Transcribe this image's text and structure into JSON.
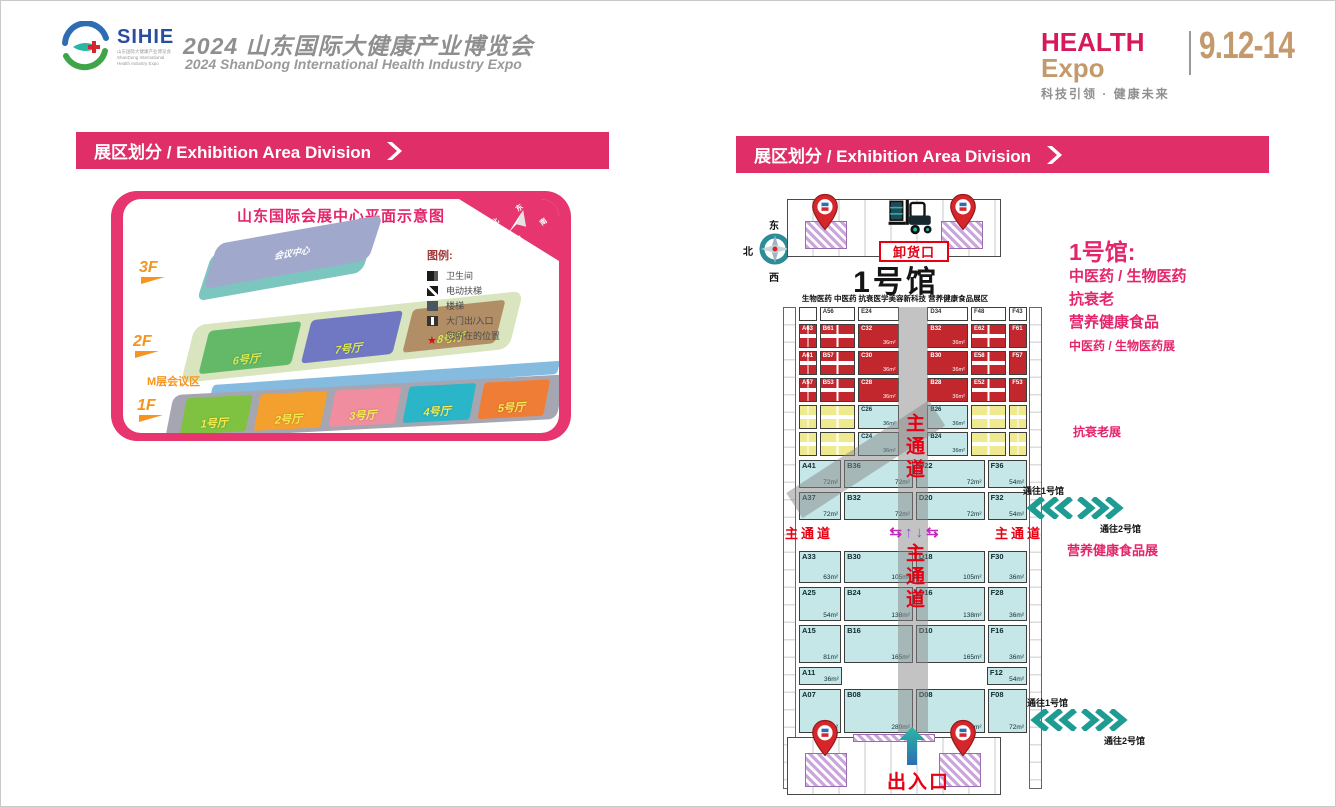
{
  "header": {
    "logo": {
      "name": "SIHIE",
      "sub": [
        {
          "t": "山东国际大健康产业博览会"
        },
        {
          "t": "ShanDong International"
        },
        {
          "t": "Health Industry Expo"
        }
      ]
    },
    "title_cn": "2024 山东国际大健康产业博览会",
    "title_en": "2024 ShanDong International Health Industry Expo",
    "brand": {
      "health": "HEALTH",
      "expo": "Expo",
      "slogan": "科技引领 · 健康未来",
      "dates": "9.12-14"
    }
  },
  "banners": {
    "left": "展区划分 / Exhibition Area Division",
    "right": "展区划分 / Exhibition Area Division"
  },
  "venue_map": {
    "title": "山东国际会展中心平面示意图",
    "compass": {
      "n": "北",
      "e": "东",
      "s": "南",
      "w": "西"
    },
    "floor_3f": "3F",
    "floor_2f": "2F",
    "floor_1f": "1F",
    "building_3f": "会议中心",
    "m_label": "M层会议区",
    "halls_2f": [
      {
        "name": "6号厅",
        "bg": "#63B968"
      },
      {
        "name": "7号厅",
        "bg": "#7078C4"
      },
      {
        "name": "8号厅",
        "bg": "#B28E67"
      }
    ],
    "halls_1f": [
      {
        "name": "1号厅",
        "bg": "#7FC242"
      },
      {
        "name": "2号厅",
        "bg": "#F4A02F"
      },
      {
        "name": "3号厅",
        "bg": "#F08EA0"
      },
      {
        "name": "4号厅",
        "bg": "#2BB5C8"
      },
      {
        "name": "5号厅",
        "bg": "#F07D35"
      }
    ],
    "legend_title": "图例:",
    "legend": [
      {
        "icon": "restroom-icon",
        "label": "卫生间"
      },
      {
        "icon": "escalator-icon",
        "label": "电动扶梯"
      },
      {
        "icon": "stairs-icon",
        "label": "楼梯"
      },
      {
        "icon": "gate-icon",
        "label": "大门出/入口"
      },
      {
        "icon": "location-star-icon",
        "label": "您所在的位置"
      }
    ]
  },
  "hall_map": {
    "compass": {
      "n": "北",
      "e": "东",
      "s": "南",
      "w": "西"
    },
    "unloading_label": "卸货口",
    "title": "1号馆",
    "subtitle": "生物医药 中医药 抗衰医学美容新科技 营养健康食品展区",
    "aisle_h": "主通道",
    "aisle_v": "主通道",
    "entrance_label": "出入口",
    "arrows": {
      "left": "⇆",
      "up": "↑",
      "down": "↓",
      "right": "⇆"
    },
    "upper_rows": [
      {
        "h": "14px",
        "cells": [
          {
            "cls": "booth",
            "l": "",
            "bg": "#FFFFFF",
            "fg": "#333333",
            "fl": "0.9"
          },
          {
            "cls": "booth",
            "l": "A56",
            "bg": "#FFFFFF",
            "fg": "#333333",
            "fl": "1.9"
          },
          {
            "cls": "booth",
            "l": "E24",
            "bg": "#FFFFFF",
            "fg": "#333333",
            "fl": "2.2"
          },
          {
            "cls": "booth empty",
            "l": "",
            "fl": "1.3"
          },
          {
            "cls": "booth",
            "l": "D34",
            "bg": "#FFFFFF",
            "fg": "#333333",
            "fl": "2.2"
          },
          {
            "cls": "booth",
            "l": "F48",
            "bg": "#FFFFFF",
            "fg": "#333333",
            "fl": "1.9"
          },
          {
            "cls": "booth",
            "l": "F43",
            "bg": "#FFFFFF",
            "fg": "#333333",
            "fl": "0.9"
          }
        ]
      },
      {
        "h": "24px",
        "cells": [
          {
            "cls": "booth quad",
            "l": "A63",
            "bg": "#C1272D",
            "fg": "#FFFFFF",
            "fl": "0.9"
          },
          {
            "cls": "booth quad",
            "l": "B61",
            "bg": "#C1272D",
            "fg": "#FFFFFF",
            "fl": "1.9"
          },
          {
            "cls": "booth",
            "l": "C32",
            "a": "36m²",
            "bg": "#C1272D",
            "fg": "#FFFFFF",
            "fl": "2.2"
          },
          {
            "cls": "booth empty",
            "l": "",
            "fl": "1.3"
          },
          {
            "cls": "booth",
            "l": "B32",
            "a": "36m²",
            "bg": "#C1272D",
            "fg": "#FFFFFF",
            "fl": "2.2"
          },
          {
            "cls": "booth quad",
            "l": "E62",
            "bg": "#C1272D",
            "fg": "#FFFFFF",
            "fl": "1.9"
          },
          {
            "cls": "booth",
            "l": "F61",
            "bg": "#C1272D",
            "fg": "#FFFFFF",
            "fl": "0.9"
          }
        ]
      },
      {
        "h": "24px",
        "cells": [
          {
            "cls": "booth quad",
            "l": "A61",
            "bg": "#C1272D",
            "fg": "#FFFFFF",
            "fl": "0.9"
          },
          {
            "cls": "booth quad",
            "l": "B57",
            "bg": "#C1272D",
            "fg": "#FFFFFF",
            "fl": "1.9"
          },
          {
            "cls": "booth",
            "l": "C30",
            "a": "36m²",
            "bg": "#C1272D",
            "fg": "#FFFFFF",
            "fl": "2.2"
          },
          {
            "cls": "booth empty",
            "l": "",
            "fl": "1.3"
          },
          {
            "cls": "booth",
            "l": "B30",
            "a": "36m²",
            "bg": "#C1272D",
            "fg": "#FFFFFF",
            "fl": "2.2"
          },
          {
            "cls": "booth quad",
            "l": "E58",
            "bg": "#C1272D",
            "fg": "#FFFFFF",
            "fl": "1.9"
          },
          {
            "cls": "booth",
            "l": "F57",
            "bg": "#C1272D",
            "fg": "#FFFFFF",
            "fl": "0.9"
          }
        ]
      },
      {
        "h": "24px",
        "cells": [
          {
            "cls": "booth quad",
            "l": "A57",
            "bg": "#C1272D",
            "fg": "#FFFFFF",
            "fl": "0.9"
          },
          {
            "cls": "booth quad",
            "l": "B53",
            "bg": "#C1272D",
            "fg": "#FFFFFF",
            "fl": "1.9"
          },
          {
            "cls": "booth",
            "l": "C28",
            "a": "36m²",
            "bg": "#C1272D",
            "fg": "#FFFFFF",
            "fl": "2.2"
          },
          {
            "cls": "booth empty",
            "l": "",
            "fl": "1.3"
          },
          {
            "cls": "booth",
            "l": "B28",
            "a": "36m²",
            "bg": "#C1272D",
            "fg": "#FFFFFF",
            "fl": "2.2"
          },
          {
            "cls": "booth quad",
            "l": "E52",
            "bg": "#C1272D",
            "fg": "#FFFFFF",
            "fl": "1.9"
          },
          {
            "cls": "booth",
            "l": "F53",
            "bg": "#C1272D",
            "fg": "#FFFFFF",
            "fl": "0.9"
          }
        ]
      },
      {
        "h": "24px",
        "cells": [
          {
            "cls": "booth quad",
            "l": "",
            "bg": "#EFE98F",
            "fg": "#8a7d2a",
            "fl": "0.9"
          },
          {
            "cls": "booth quad",
            "l": "",
            "bg": "#EFE98F",
            "fg": "#8a7d2a",
            "fl": "1.9"
          },
          {
            "cls": "booth",
            "l": "C26",
            "a": "36m²",
            "bg": "#C5E7E8",
            "fg": "#12343a",
            "fl": "2.2"
          },
          {
            "cls": "booth empty",
            "l": "",
            "fl": "1.3"
          },
          {
            "cls": "booth",
            "l": "B26",
            "a": "36m²",
            "bg": "#C5E7E8",
            "fg": "#12343a",
            "fl": "2.2"
          },
          {
            "cls": "booth quad",
            "l": "",
            "bg": "#EFE98F",
            "fg": "#8a7d2a",
            "fl": "1.9"
          },
          {
            "cls": "booth quad",
            "l": "",
            "bg": "#EFE98F",
            "fg": "#8a7d2a",
            "fl": "0.9"
          }
        ]
      },
      {
        "h": "24px",
        "cells": [
          {
            "cls": "booth quad",
            "l": "",
            "bg": "#EFE98F",
            "fg": "#8a7d2a",
            "fl": "0.9"
          },
          {
            "cls": "booth quad",
            "l": "",
            "bg": "#EFE98F",
            "fg": "#8a7d2a",
            "fl": "1.9"
          },
          {
            "cls": "booth",
            "l": "C24",
            "a": "36m²",
            "bg": "#C5E7E8",
            "fg": "#12343a",
            "fl": "2.2"
          },
          {
            "cls": "booth empty",
            "l": "",
            "fl": "1.3"
          },
          {
            "cls": "booth",
            "l": "B24",
            "a": "36m²",
            "bg": "#C5E7E8",
            "fg": "#12343a",
            "fl": "2.2"
          },
          {
            "cls": "booth quad",
            "l": "",
            "bg": "#EFE98F",
            "fg": "#8a7d2a",
            "fl": "1.9"
          },
          {
            "cls": "booth quad",
            "l": "",
            "bg": "#EFE98F",
            "fg": "#8a7d2a",
            "fl": "0.9"
          }
        ]
      }
    ],
    "lower_rows_a": [
      {
        "h": "28px",
        "cells": [
          {
            "cls": "booth",
            "l": "A41",
            "a": "72m²",
            "bg": "#C5E7E8",
            "fg": "#102a2e",
            "fl": "1.5"
          },
          {
            "cls": "booth",
            "l": "B36",
            "a": "72m²",
            "bg": "#C5E7E8",
            "fg": "#102a2e",
            "fl": "2.5"
          },
          {
            "cls": "booth",
            "l": "D22",
            "a": "72m²",
            "bg": "#C5E7E8",
            "fg": "#102a2e",
            "fl": "2.5"
          },
          {
            "cls": "booth",
            "l": "F36",
            "a": "54m²",
            "bg": "#C5E7E8",
            "fg": "#102a2e",
            "fl": "1.4"
          }
        ]
      },
      {
        "h": "28px",
        "cells": [
          {
            "cls": "booth",
            "l": "A37",
            "a": "72m²",
            "bg": "#C5E7E8",
            "fg": "#102a2e",
            "fl": "1.5"
          },
          {
            "cls": "booth",
            "l": "B32",
            "a": "72m²",
            "bg": "#C5E7E8",
            "fg": "#102a2e",
            "fl": "2.5"
          },
          {
            "cls": "booth",
            "l": "D20",
            "a": "72m²",
            "bg": "#C5E7E8",
            "fg": "#102a2e",
            "fl": "2.5"
          },
          {
            "cls": "booth",
            "l": "F32",
            "a": "54m²",
            "bg": "#C5E7E8",
            "fg": "#102a2e",
            "fl": "1.4"
          }
        ]
      }
    ],
    "lower_rows_b": [
      {
        "h": "32px",
        "cells": [
          {
            "cls": "booth",
            "l": "A33",
            "a": "63m²",
            "bg": "#C5E7E8",
            "fg": "#102a2e",
            "fl": "1.5"
          },
          {
            "cls": "booth",
            "l": "B30",
            "a": "105m²",
            "bg": "#C5E7E8",
            "fg": "#102a2e",
            "fl": "2.5"
          },
          {
            "cls": "booth",
            "l": "D18",
            "a": "105m²",
            "bg": "#C5E7E8",
            "fg": "#102a2e",
            "fl": "2.5"
          },
          {
            "cls": "booth",
            "l": "F30",
            "a": "36m²",
            "bg": "#C5E7E8",
            "fg": "#102a2e",
            "fl": "1.4"
          }
        ]
      },
      {
        "h": "34px",
        "cells": [
          {
            "cls": "booth",
            "l": "A25",
            "a": "54m²",
            "bg": "#C5E7E8",
            "fg": "#102a2e",
            "fl": "1.5"
          },
          {
            "cls": "booth",
            "l": "B24",
            "a": "138m²",
            "bg": "#C5E7E8",
            "fg": "#102a2e",
            "fl": "2.5"
          },
          {
            "cls": "booth",
            "l": "D16",
            "a": "138m²",
            "bg": "#C5E7E8",
            "fg": "#102a2e",
            "fl": "2.5"
          },
          {
            "cls": "booth",
            "l": "F28",
            "a": "36m²",
            "bg": "#C5E7E8",
            "fg": "#102a2e",
            "fl": "1.4"
          }
        ]
      },
      {
        "h": "38px",
        "cells": [
          {
            "cls": "booth",
            "l": "A15",
            "a": "81m²",
            "bg": "#C5E7E8",
            "fg": "#102a2e",
            "fl": "1.5"
          },
          {
            "cls": "booth",
            "l": "B16",
            "a": "165m²",
            "bg": "#C5E7E8",
            "fg": "#102a2e",
            "fl": "2.5"
          },
          {
            "cls": "booth",
            "l": "D10",
            "a": "165m²",
            "bg": "#C5E7E8",
            "fg": "#102a2e",
            "fl": "2.5"
          },
          {
            "cls": "booth",
            "l": "F16",
            "a": "36m²",
            "bg": "#C5E7E8",
            "fg": "#102a2e",
            "fl": "1.4"
          }
        ]
      },
      {
        "h": "18px",
        "cells": [
          {
            "cls": "booth",
            "l": "A11",
            "a": "36m²",
            "bg": "#C5E7E8",
            "fg": "#102a2e",
            "fl": "1.5"
          },
          {
            "cls": "booth empty",
            "l": "",
            "fl": "2.5"
          },
          {
            "cls": "booth empty",
            "l": "",
            "fl": "2.5"
          },
          {
            "cls": "booth",
            "l": "F12",
            "a": "54m²",
            "bg": "#C5E7E8",
            "fg": "#102a2e",
            "fl": "1.4"
          }
        ]
      },
      {
        "h": "44px",
        "cells": [
          {
            "cls": "booth",
            "l": "A07",
            "a": "63m²",
            "bg": "#C5E7E8",
            "fg": "#102a2e",
            "fl": "1.5"
          },
          {
            "cls": "booth",
            "l": "B08",
            "a": "280m²",
            "bg": "#C5E7E8",
            "fg": "#102a2e",
            "fl": "2.5"
          },
          {
            "cls": "booth",
            "l": "D08",
            "a": "225m²",
            "bg": "#C5E7E8",
            "fg": "#102a2e",
            "fl": "2.5"
          },
          {
            "cls": "booth",
            "l": "F08",
            "a": "72m²",
            "bg": "#C5E7E8",
            "fg": "#102a2e",
            "fl": "1.4"
          }
        ]
      }
    ]
  },
  "sidebar": {
    "title": "1号馆:",
    "lines": [
      {
        "t": "中医药 / 生物医药"
      },
      {
        "t": "抗衰老"
      },
      {
        "t": "营养健康食品"
      }
    ],
    "tag_zhongyi": "中医药 / 生物医药展",
    "tag_kangshuai": "抗衰老展",
    "tag_yingyang": "营养健康食品展",
    "passage_top": {
      "to1": "通往1号馆",
      "to2": "通往2号馆"
    },
    "passage_bottom": {
      "to1": "通往1号馆",
      "to2": "通往2号馆"
    }
  }
}
